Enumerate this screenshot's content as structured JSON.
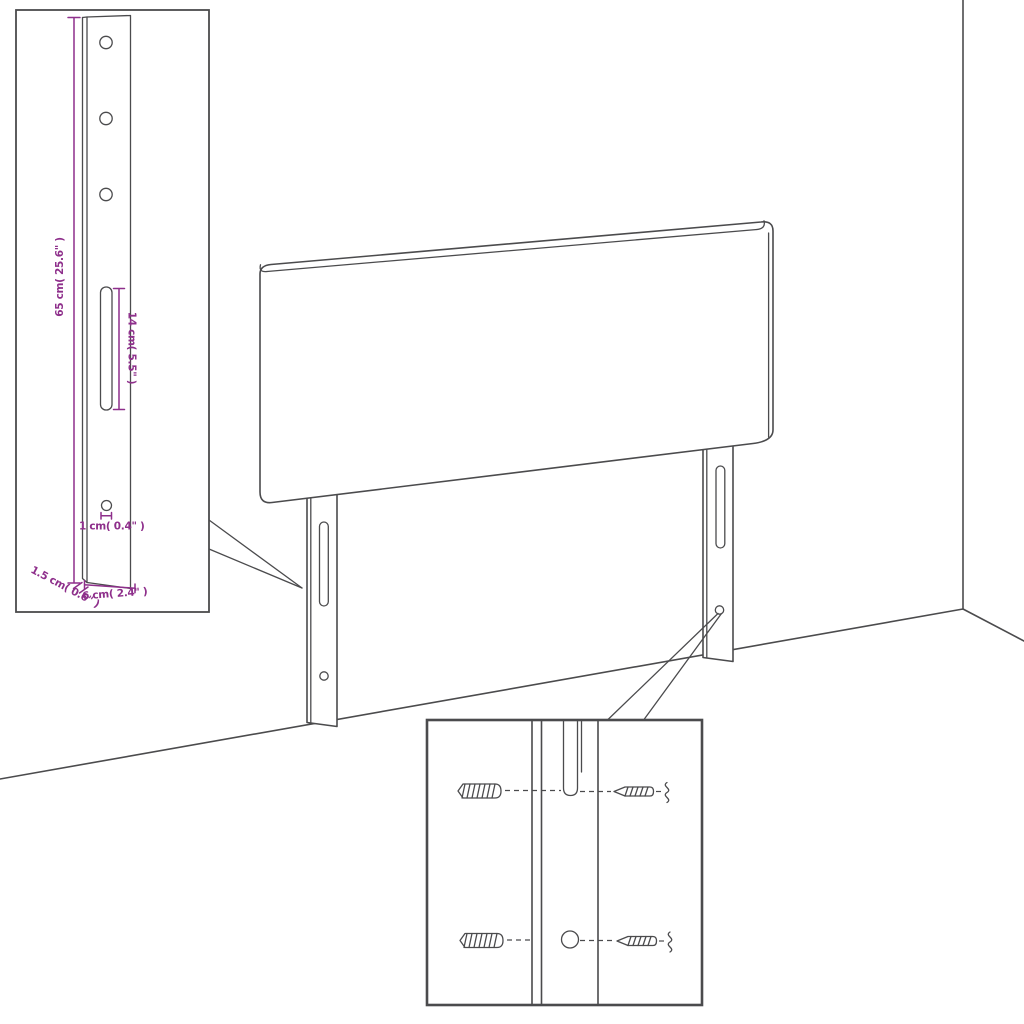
{
  "diagram": {
    "title_hint": "headboard mounting diagram",
    "colors": {
      "line": "#4b4b4d",
      "dimension": "#8e2f8b",
      "background": "#ffffff"
    },
    "bracket_inset": {
      "dimensions": {
        "height": "65 cm( 25.6\" )",
        "slot_length": "14 cm( 5.5\" )",
        "hole": "1 cm( 0.4\" )",
        "thickness": "1.5 cm( 0.6\" )",
        "width": "6 cm( 2.4\" )"
      }
    }
  }
}
